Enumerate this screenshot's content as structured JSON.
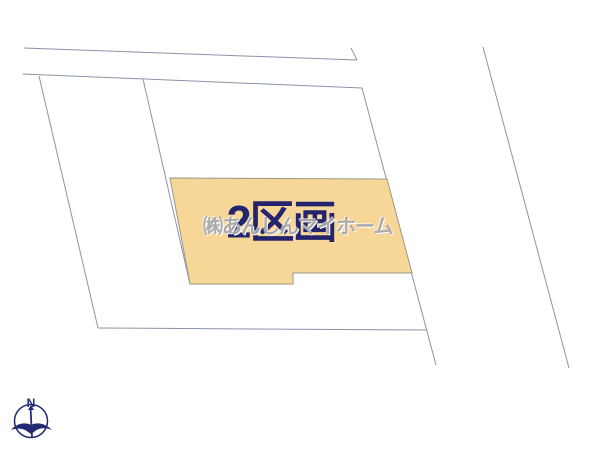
{
  "plot_map": {
    "highlighted_lot": {
      "label": "2区画",
      "fill_color": "#f6d798",
      "label_color": "#24246e"
    },
    "watermark": {
      "text": "㈱あんしんマイホーム",
      "color": "#9e9ca0"
    },
    "compass": {
      "north_label": "N",
      "color": "#232a74"
    },
    "boundary_line_color": "#8d92a8"
  }
}
